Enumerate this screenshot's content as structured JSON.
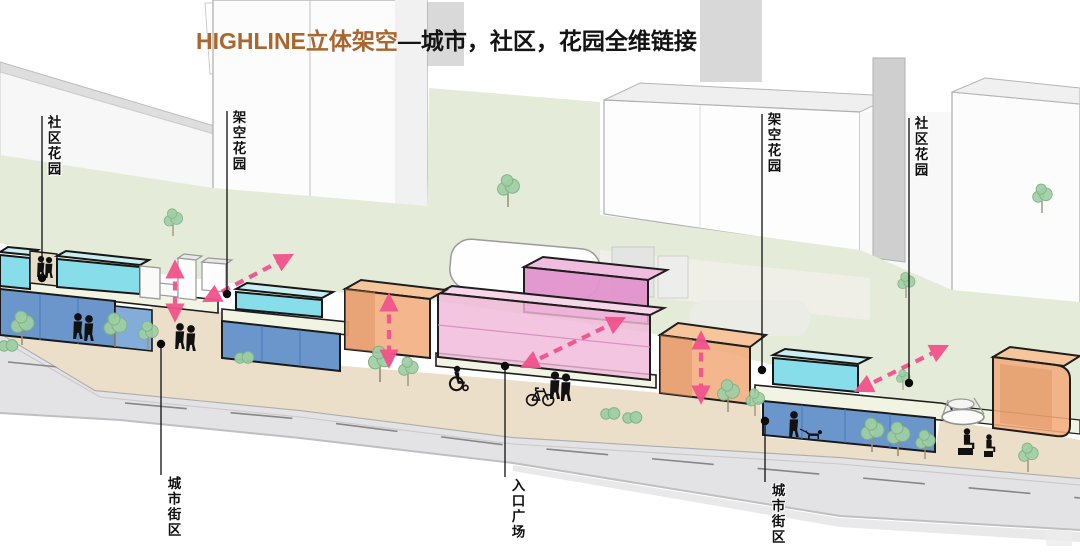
{
  "title": {
    "highlight": "HIGHLINE立体架空",
    "rest": "—城市，社区，花园全维链接"
  },
  "labels": {
    "community_garden_left": "社区花园",
    "elevated_garden_left": "架空花园",
    "elevated_garden_right": "架空花园",
    "community_garden_right": "社区花园",
    "city_block_left": "城市街区",
    "entrance_plaza": "入口广场",
    "city_block_right": "城市街区"
  },
  "colors": {
    "title_brown": "#A9662E",
    "accent_arrow": "#F2538C",
    "glass_cyan_front": "#87DDE9",
    "glass_cyan_top": "#C9EEF1",
    "podium_blue": "#6A96CC",
    "podium_blue_light": "#84ACD8",
    "box_orange_front": "#F3AC7C",
    "box_orange_top": "#F7C59C",
    "box_pink_front": "#F2B8DA",
    "box_magenta_front": "#E293CC",
    "lawn_green": "#E4EBD8",
    "sidewalk_beige": "#EBDFC9",
    "road_grey": "#E3E3E5",
    "deck_cream": "#F2F4E3"
  }
}
